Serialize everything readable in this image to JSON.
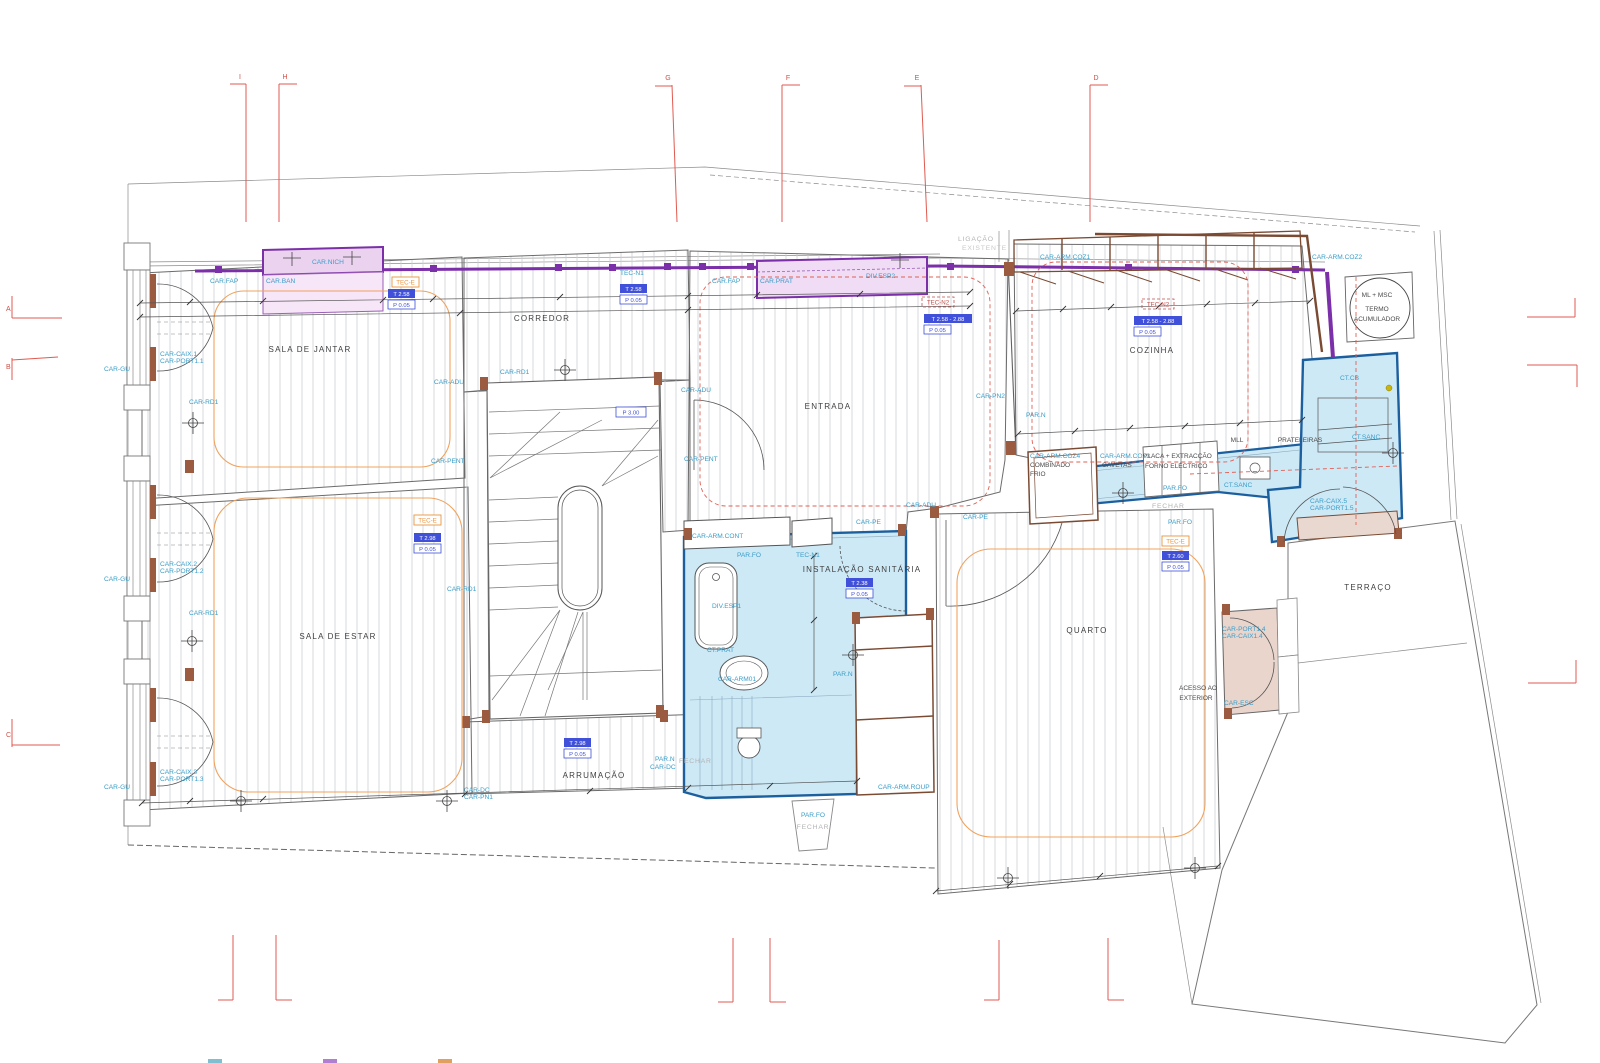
{
  "labels": {
    "ligacao": "LIGAÇÃO",
    "existente": "EXISTENTE",
    "sala_jantar": "SALA DE JANTAR",
    "corredor": "CORREDOR",
    "entrada": "ENTRADA",
    "cozinha": "COZINHA",
    "sala_estar": "SALA DE ESTAR",
    "inst_sanitaria": "INSTALAÇÃO SANITÁRIA",
    "quarto": "QUARTO",
    "arrumacao": "ARRUMAÇÃO",
    "terraco": "TERRAÇO",
    "acesso_l1": "ACESSO AO",
    "acesso_l2": "EXTERIOR",
    "prateleiras": "PRATELEIRAS",
    "mll": "MLL",
    "combinado": "COMBINADO",
    "frio": "FRIO",
    "gavetas": "GAVETAS",
    "placa": "PLACA + EXTRACÇÃO",
    "forno": "FORNO ELÉCTRICO",
    "ml_msc": "ML + MSC",
    "termo": "TERMO",
    "acumulador": "ACUMULADOR",
    "fechar": "FECHAR",
    "car_nich": "CAR.NICH",
    "car_fap": "CAR.FAP",
    "car_ban": "CAR.BAN",
    "car_prat": "CAR.PRAT",
    "div_esp1": "DIV.ESP1",
    "div_esp2": "DIV.ESP2",
    "car_arm_coz1": "CAR-ARM.COZ1",
    "car_arm_coz2": "CAR-ARM.COZ2",
    "car_arm_coz3": "CAR-ARM.COZ3",
    "car_arm_coz4": "CAR-ARM.COZ4",
    "car_arm_cont": "CAR-ARM.CONT",
    "car_arm_roup": "CAR-ARM.ROUP",
    "car_arm01": "CAR-ARM01",
    "car_caix1": "CAR-CAIX.1",
    "car_port1_1": "CAR-PORT1.1",
    "car_caix2": "CAR-CAIX.2",
    "car_port1_2": "CAR-PORT1.2",
    "car_caix3": "CAR-CAIX.3",
    "car_port1_3": "CAR-PORT1.3",
    "car_port1_4": "CAR-PORT1.4",
    "car_caix1_4": "CAR-CAIX1.4",
    "car_caix5": "CAR-CAIX.5",
    "car_port1_5": "CAR-PORT1.5",
    "car_gu": "CAR-GU",
    "car_rd1": "CAR-RD1",
    "car_adu": "CAR-ADU",
    "car_pent": "CAR-PENT",
    "car_pe": "CAR-PE",
    "car_pn1": "CAR-PN1",
    "car_pn2": "CAR-PN2",
    "car_dc": "CAR-DC",
    "car_esc": "CAR-ESC",
    "ct_cb": "CT.CB",
    "ct_sanc": "CT.SANC",
    "ct_prat": "CT.PRAT",
    "par_n": "PAR.N",
    "par_fo": "PAR.FO",
    "tec_e": "TEC-E",
    "tec_n1": "TEC-N1",
    "tec_n2": "TEC-N2"
  },
  "values": {
    "t258": "T 2.58",
    "p005": "P 0.05",
    "t258_288": "T 2.58 - 2.88",
    "t238": "T 2.38",
    "t260": "T 2.60",
    "t298": "T 2.98",
    "p300": "P 3.00"
  },
  "grid": {
    "a": "A",
    "b": "B",
    "c": "C",
    "d": "D",
    "e": "E",
    "f": "F",
    "g": "G",
    "h": "H",
    "i": "I"
  },
  "colors": {
    "label_blue": "#3A9DC8",
    "wall_purple": "#7B2FA8",
    "sanitary_fill": "#CDE9F6",
    "sanitary_stroke": "#1C5F9E",
    "cabinet_pink": "#F0DCF4",
    "tec_orange": "#E8953C",
    "value_blue": "#4050D8",
    "marker_red": "#E05A50",
    "wood_brown": "#9A5B40",
    "hatch_gray": "#C9CED5",
    "legend_chip_teal": "#7FBFCF",
    "legend_chip_purple": "#B07FD0",
    "legend_chip_orange": "#E0A060"
  }
}
